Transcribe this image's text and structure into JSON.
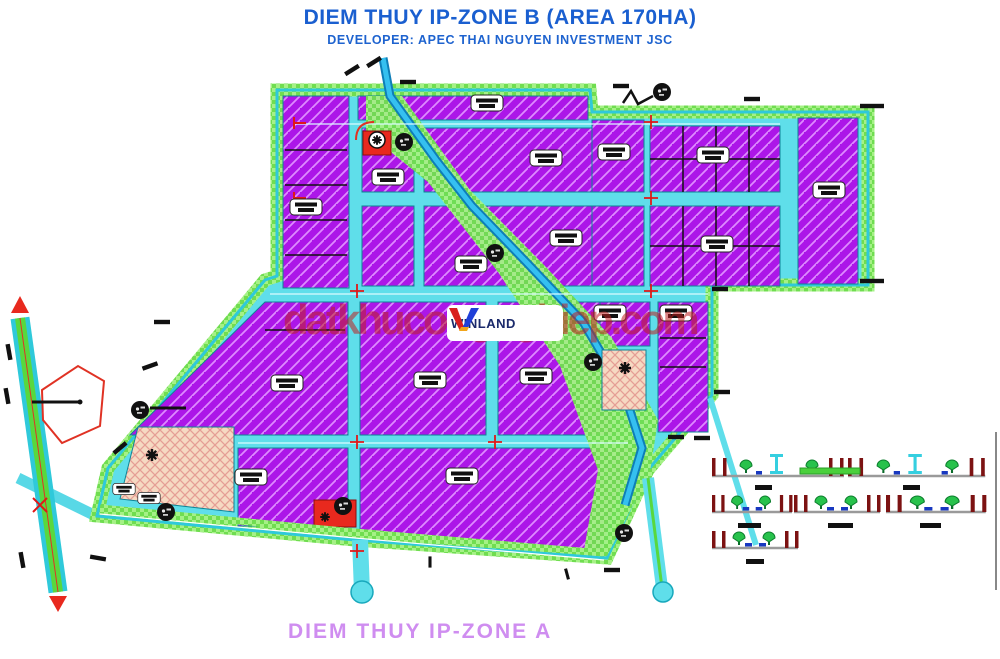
{
  "header": {
    "title": "DIEM THUY IP-ZONE B (AREA 170HA)",
    "subtitle": "DEVELOPER: APEC THAI NGUYEN INVESTMENT JSC"
  },
  "watermark": {
    "text": "datkhucongnghiep.com"
  },
  "logo": {
    "brand": "WINLAND",
    "mark": "V"
  },
  "footer": {
    "zone_label": "DIEM THUY IP-ZONE A"
  },
  "colors": {
    "title_blue": "#1a5fd0",
    "plot_purple": "#ac16e8",
    "plot_hatch": "#de8bff",
    "road_cyan": "#5fdeea",
    "green_buffer": "#70dd50",
    "stream_blue": "#35c0f0",
    "pink_plot": "#f6d9c2",
    "highlight_red": "#e8291e",
    "watermark_red": "#c02020",
    "footer_violet": "#cf8df0"
  },
  "map": {
    "icons": [
      "survey-marker-icon",
      "plot-label-chip",
      "intersection-cross-icon",
      "star-marker-icon",
      "tree-icon",
      "light-pole-icon",
      "flow-arrow-icon"
    ],
    "features": {
      "industrial_plots": "purple hatched parcels",
      "boundary_buffer": "green hatched strip",
      "stream_corridor": "blue stream with green buffer",
      "cross_sections_count": 6
    }
  }
}
